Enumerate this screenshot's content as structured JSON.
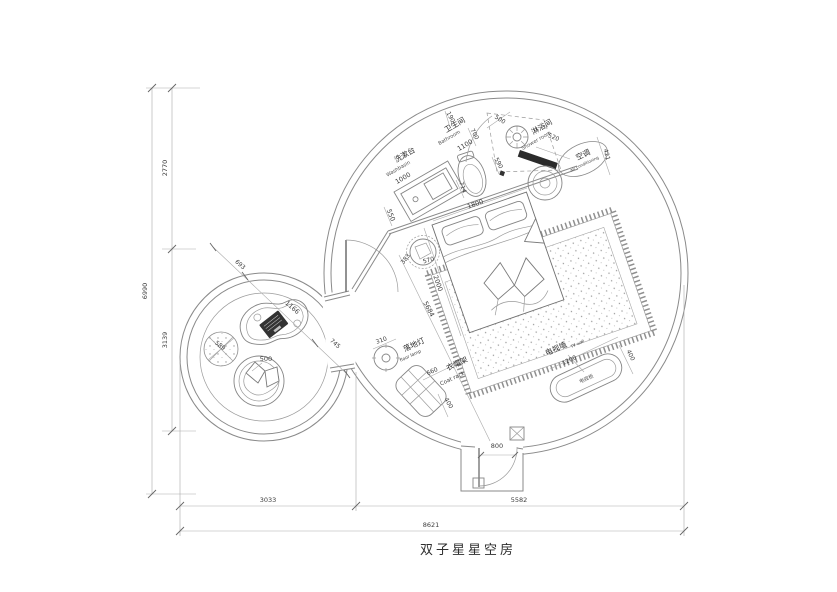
{
  "title": "双子星星空房",
  "plan": {
    "bathroom": {
      "zh": "卫生间",
      "en": "Bathroom",
      "width": "1100",
      "top": "190",
      "side": "700",
      "door": "500",
      "gap": "590"
    },
    "washbasin": {
      "zh": "洗漱台",
      "en": "Washbasin",
      "length": "1000",
      "offset": "550"
    },
    "toilet": {
      "front": "714"
    },
    "shower": {
      "zh": "淋浴间",
      "en": "Shower room"
    },
    "ac": {
      "zh": "空调",
      "en": "air conditioning",
      "offset": "520",
      "depth": "421"
    },
    "bed": {
      "width": "1800",
      "length": "2000",
      "diagonal": "5684",
      "stool_a": "383",
      "stool_b": "570"
    },
    "floor_lamp": {
      "zh": "落地灯",
      "en": "floor lamp",
      "dia": "310"
    },
    "coat_rack": {
      "zh": "衣帽架",
      "en": "Coat rack",
      "width": "660",
      "depth": "400"
    },
    "tv": {
      "zh": "电视墙",
      "en": "TV wall",
      "cabinet": "电视柜",
      "width": "1200",
      "depth": "400"
    },
    "entry": {
      "door": "800"
    },
    "lounge": {
      "edge": "693",
      "table": "1166",
      "gap": "745",
      "pouf": "589",
      "chair": "500"
    }
  },
  "dimensions": {
    "left": {
      "total": "6990",
      "top": "2770",
      "bottom": "3139"
    },
    "bottom": {
      "left": "3033",
      "right": "5582",
      "total": "8621"
    }
  }
}
